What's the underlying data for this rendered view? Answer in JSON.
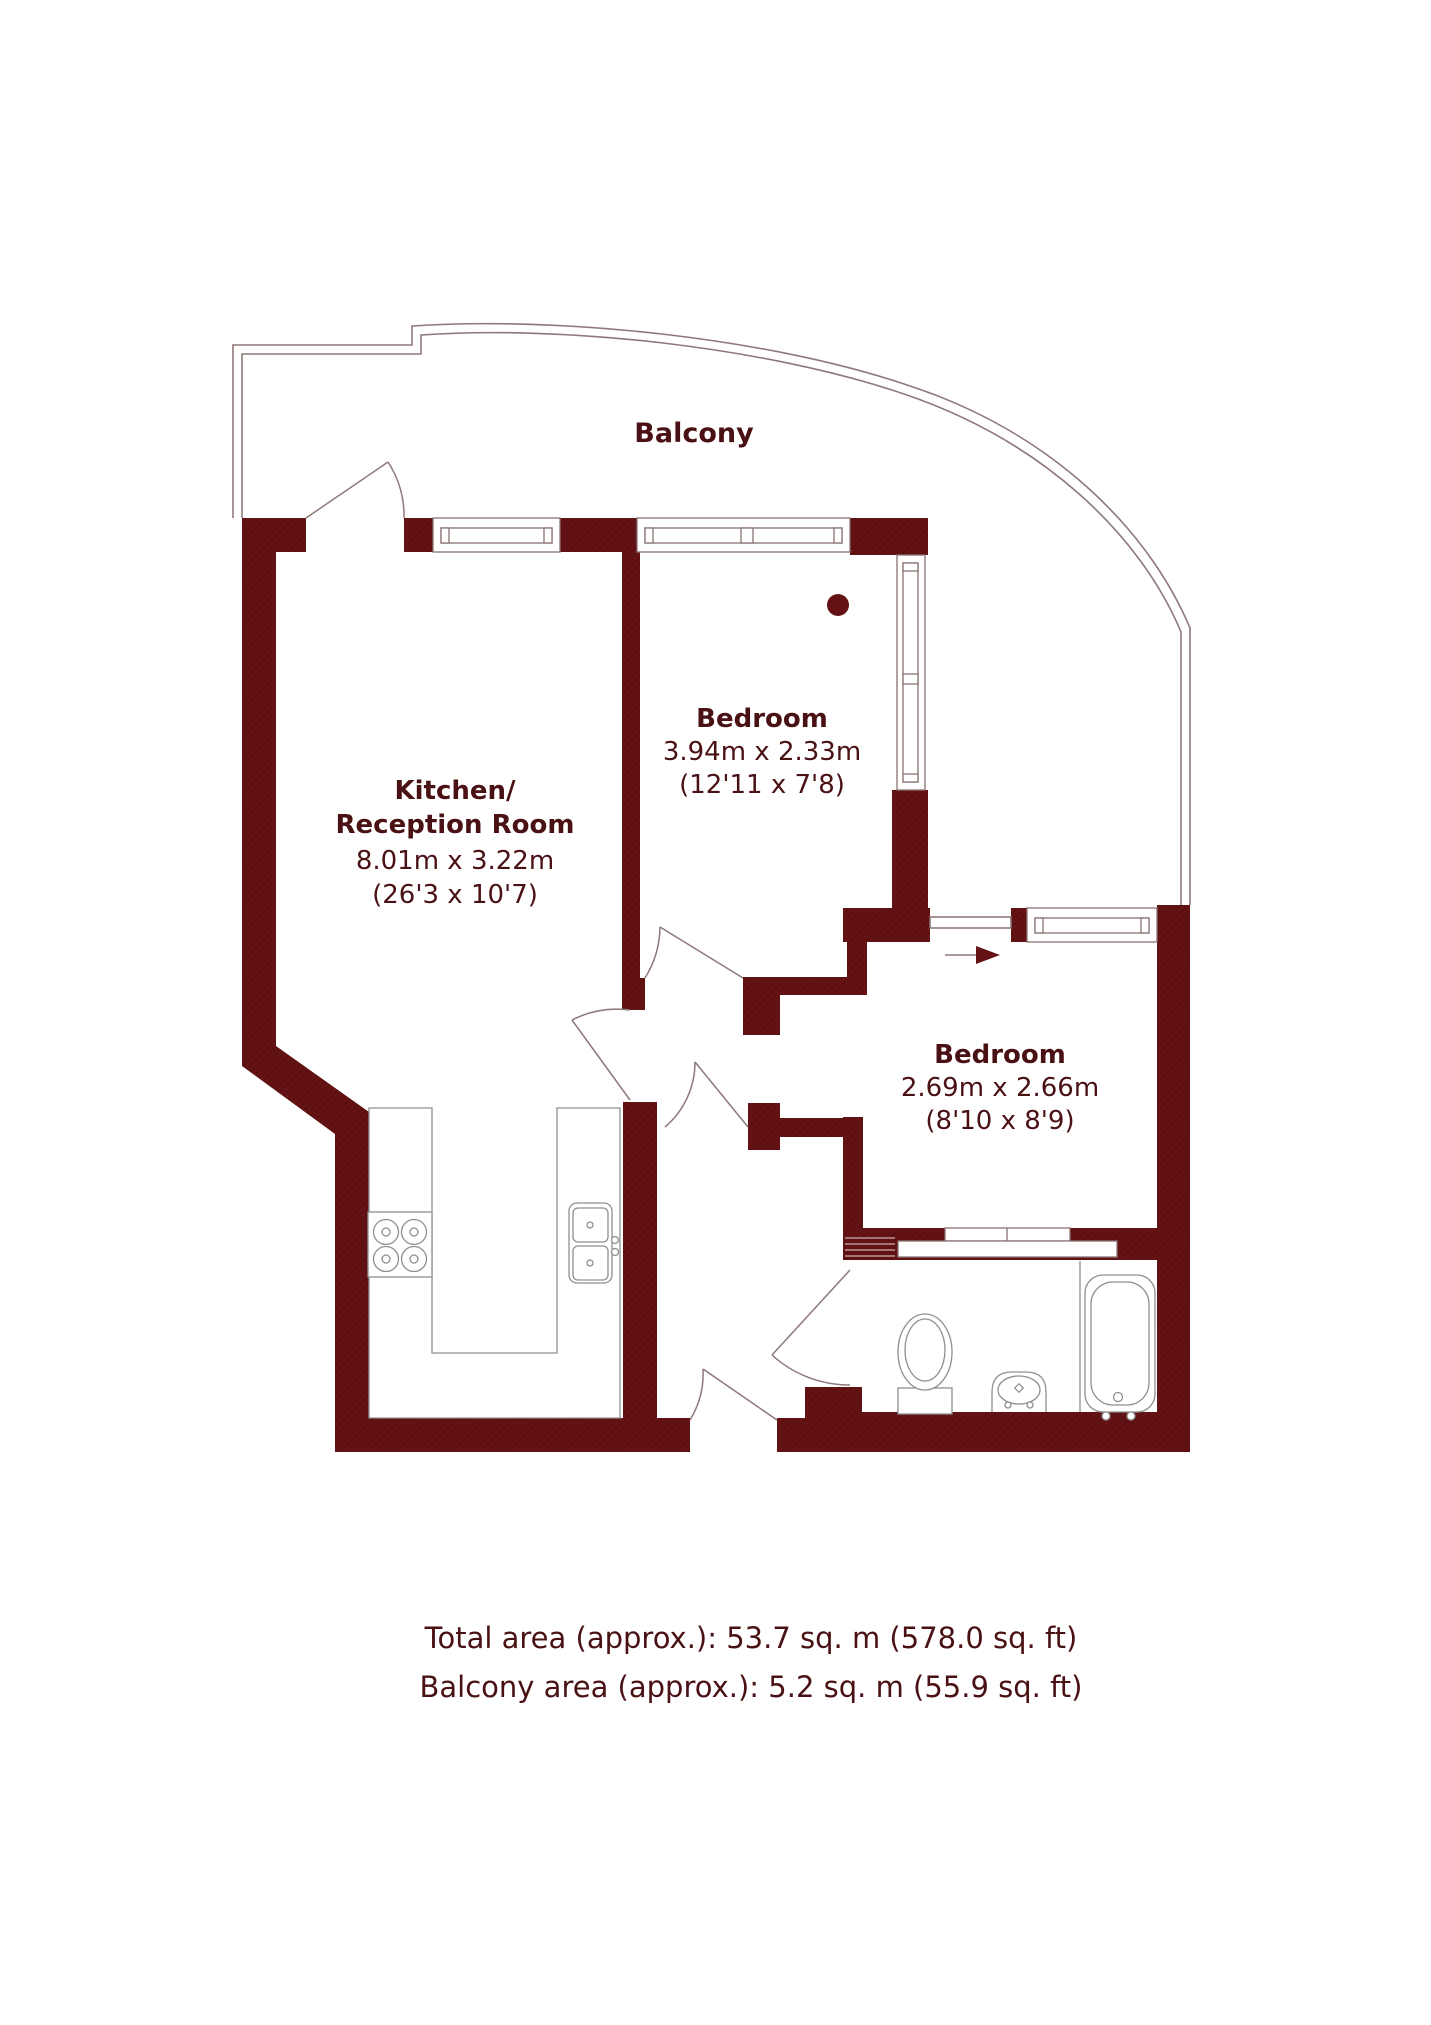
{
  "balcony": {
    "label": "Balcony"
  },
  "rooms": {
    "kitchen": {
      "line1": "Kitchen/",
      "line2": "Reception Room",
      "dims_m": "8.01m x 3.22m",
      "dims_ft": "(26'3 x 10'7)"
    },
    "bedroom1": {
      "name": "Bedroom",
      "dims_m": "3.94m x 2.33m",
      "dims_ft": "(12'11 x 7'8)"
    },
    "bedroom2": {
      "name": "Bedroom",
      "dims_m": "2.69m x 2.66m",
      "dims_ft": "(8'10 x 8'9)"
    }
  },
  "footer": {
    "total_area": "Total area (approx.): 53.7 sq. m (578.0 sq. ft)",
    "balcony_area": "Balcony area (approx.): 5.2 sq. m (55.9 sq. ft)"
  },
  "colors": {
    "wall": "#641213",
    "wall_hatch": "#541010",
    "text": "#4a1114",
    "outline": "#8f7878",
    "fixture": "#8f8f8f"
  }
}
